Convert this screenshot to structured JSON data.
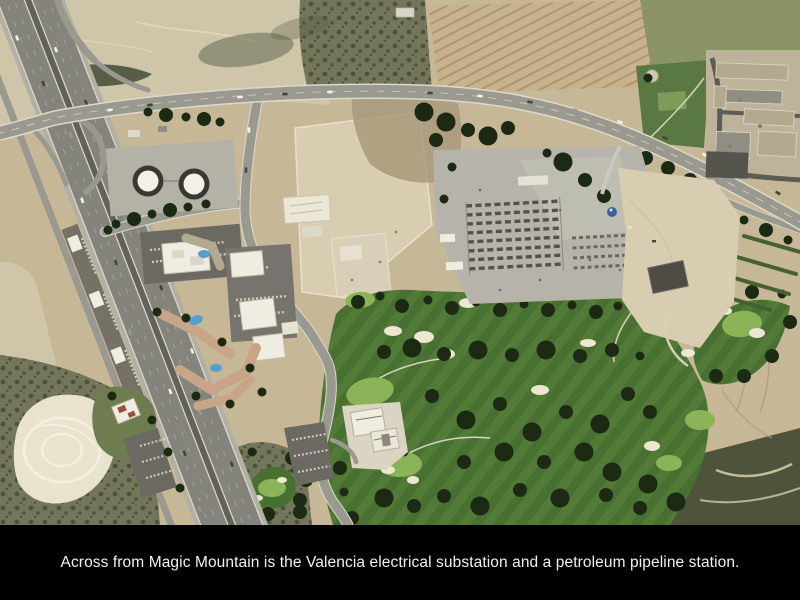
{
  "slide": {
    "caption": "Across from Magic Mountain is the Valencia electrical substation and a petroleum pipeline station.",
    "photo_alt": "Aerial photograph: Interstate 5 freeway running diagonally at left with an interchange, two white petroleum storage tanks in dark containment rings, a grey pipeline-station and electrical-substation equipment yard at center right, graded construction pads in the center, office buildings and apartment complexes along the freeway, a tree-lined golf course with sand bunkers at lower right, a residential neighborhood at upper right, and brush-covered hills at the edges."
  },
  "scene": {
    "features": [
      "interstate-5-freeway",
      "freeway-interchange",
      "arterial-road",
      "petroleum-storage-tanks",
      "pipeline-station-yard",
      "electrical-substation",
      "graded-construction-pads",
      "office-buildings",
      "apartment-complex",
      "hotel-building",
      "golf-course",
      "golf-clubhouse",
      "sand-bunkers",
      "tree-lines",
      "residential-neighborhood",
      "neighborhood-park",
      "row-crop-field",
      "scrub-hills",
      "sandy-wash"
    ]
  },
  "colors": {
    "page_bg": "#000000",
    "caption_text": "#f1f1f1",
    "dirt": "#c6b897",
    "dirt_light": "#d8cdb0",
    "dirt_pale": "#cfc5a9",
    "sand": "#e9e2cc",
    "grass_slope": "#8a9465",
    "park": "#5a7842",
    "golf": "#487031",
    "golf_light": "#5a823d",
    "green_bright": "#8ab457",
    "tree": "#1c2a13",
    "scrub": "#73765a",
    "scrub_dark": "#4d543b",
    "field": "#c8b28d",
    "field_row": "#a78f6a",
    "road": "#9a998f",
    "road_edge": "#dcd9cb",
    "freeway": "#84847c",
    "shoulder": "#b2b0a4",
    "median": "#62625a",
    "yard": "#b6b4aa",
    "parking": "#6b6961",
    "bldg_white": "#efede2",
    "roof_salmon": "#c8a488",
    "roof_tan": "#b3a98f",
    "roof_grey": "#908e84",
    "dark_roof": "#4e4c44",
    "tank_ring": "#3a3832",
    "tank": "#f2f0e7",
    "pool": "#52a0cc",
    "dome": "#3a5f9e",
    "equip": "#54524a"
  }
}
